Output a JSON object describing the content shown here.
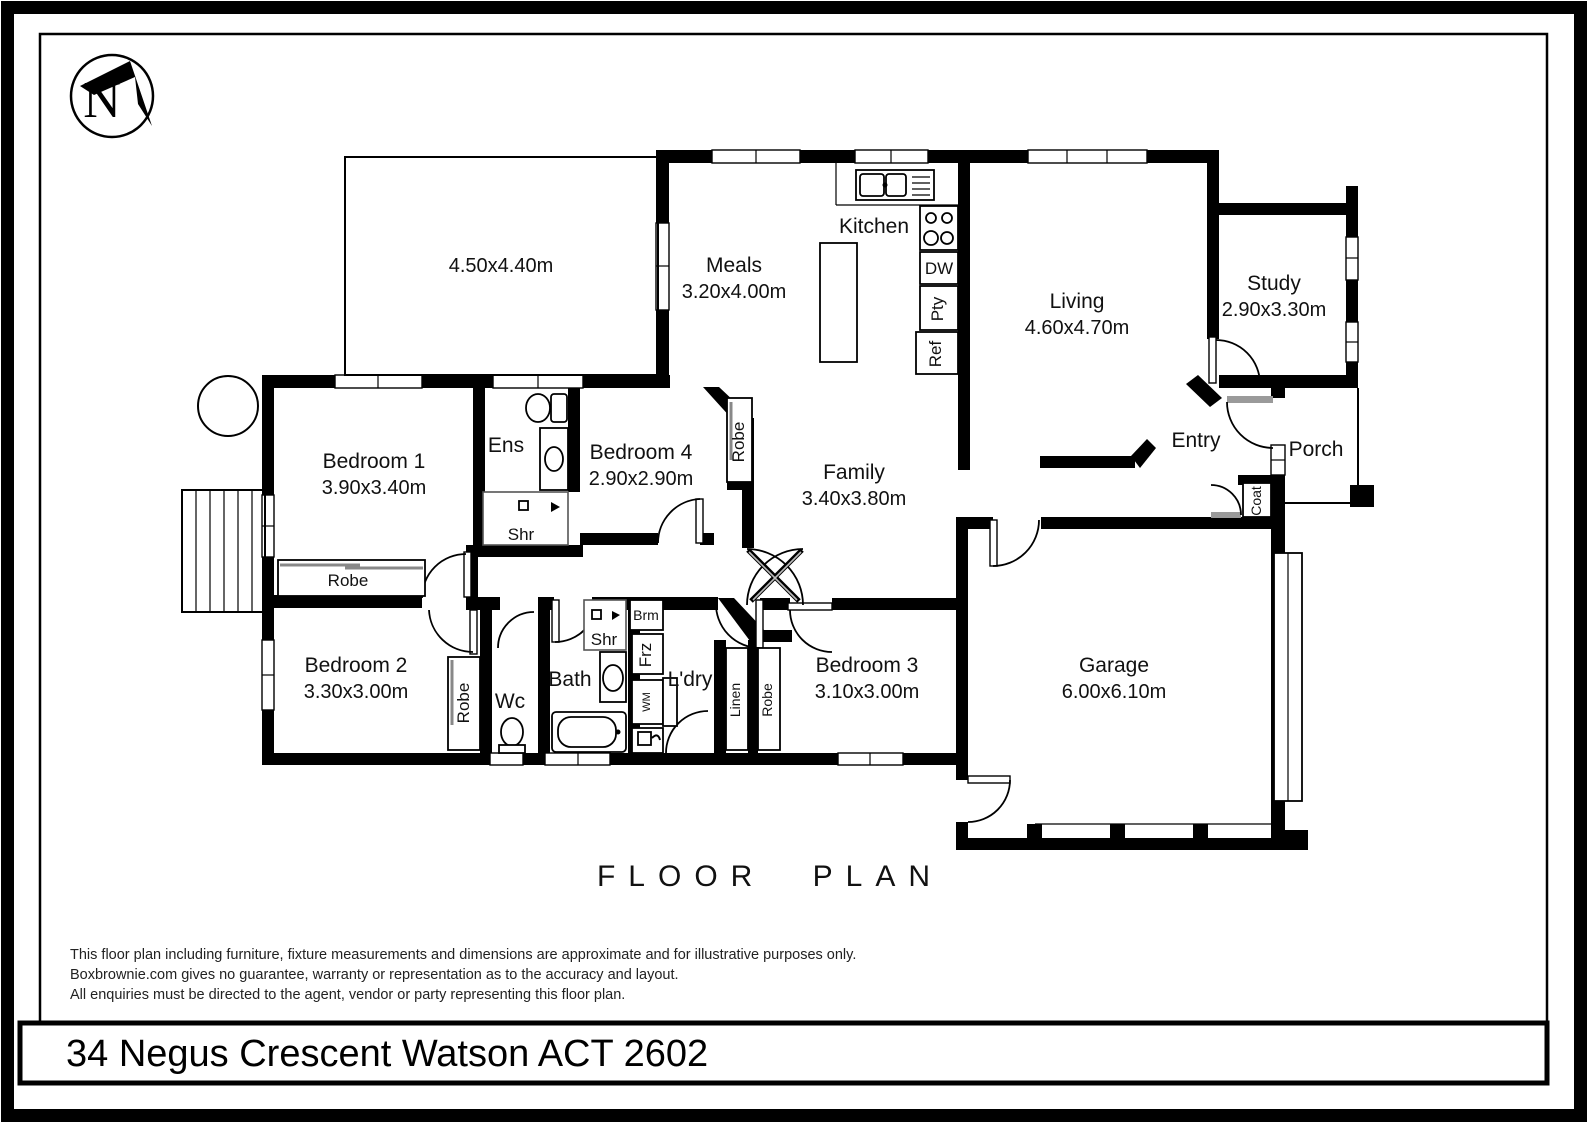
{
  "north_indicator": {
    "letter": "N"
  },
  "plan": {
    "title": "FLOOR PLAN",
    "address": "34 Negus Crescent Watson ACT 2602",
    "disclaimer": [
      "This floor plan including furniture, fixture measurements and dimensions are approximate and for illustrative purposes only.",
      "Boxbrownie.com gives no guarantee, warranty or representation as to the accuracy and layout.",
      "All enquiries must be directed to the agent, vendor or party representing this floor plan."
    ]
  },
  "rooms": {
    "outdoor_area": {
      "dim": "4.50x4.40m"
    },
    "meals": {
      "name": "Meals",
      "dim": "3.20x4.00m"
    },
    "kitchen": {
      "name": "Kitchen"
    },
    "living": {
      "name": "Living",
      "dim": "4.60x4.70m"
    },
    "study": {
      "name": "Study",
      "dim": "2.90x3.30m"
    },
    "family": {
      "name": "Family",
      "dim": "3.40x3.80m"
    },
    "entry": {
      "name": "Entry"
    },
    "porch": {
      "name": "Porch"
    },
    "garage": {
      "name": "Garage",
      "dim": "6.00x6.10m"
    },
    "bedroom1": {
      "name": "Bedroom 1",
      "dim": "3.90x3.40m"
    },
    "bedroom2": {
      "name": "Bedroom 2",
      "dim": "3.30x3.00m"
    },
    "bedroom3": {
      "name": "Bedroom 3",
      "dim": "3.10x3.00m"
    },
    "bedroom4": {
      "name": "Bedroom 4",
      "dim": "2.90x2.90m"
    },
    "ensuite": {
      "name": "Ens"
    },
    "bathroom": {
      "name": "Bath"
    },
    "wc": {
      "name": "Wc"
    },
    "laundry": {
      "name": "L'dry"
    }
  },
  "fixtures": {
    "shower": "Shr",
    "robe": "Robe",
    "linen": "Linen",
    "coat": "Coat",
    "broom": "Brm",
    "freezer": "Frz",
    "washing_machine": "WM",
    "dishwasher": "DW",
    "pantry": "Pty",
    "refrigerator": "Ref"
  }
}
